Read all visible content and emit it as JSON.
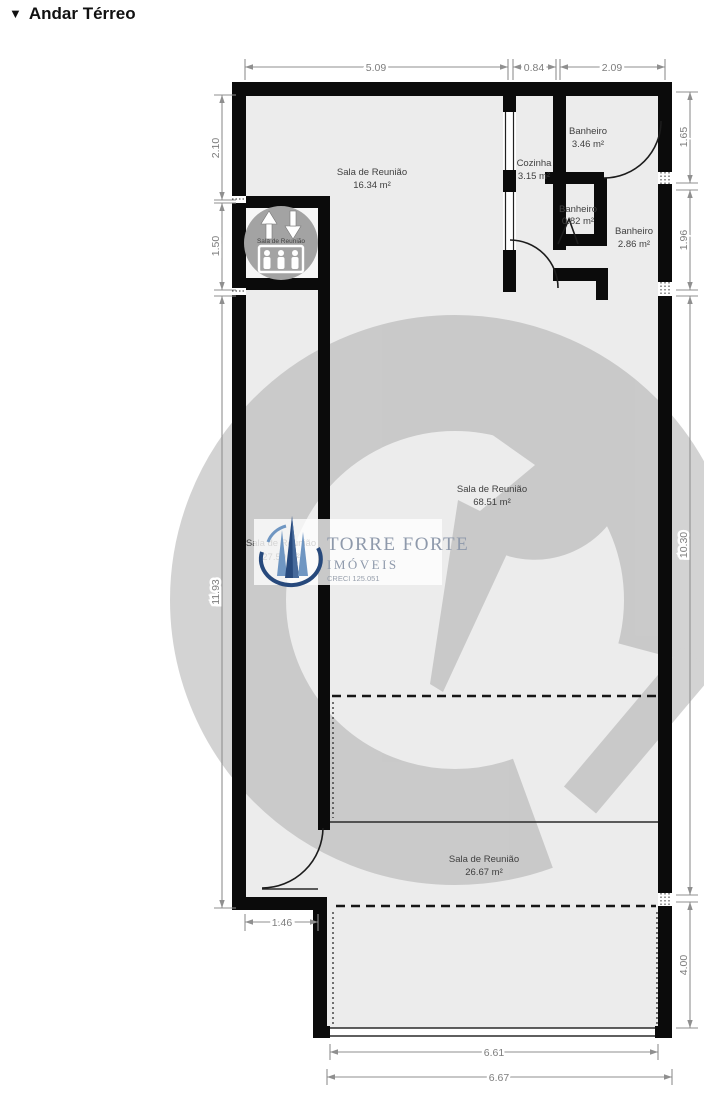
{
  "title": {
    "marker": "▼",
    "text": "Andar Térreo"
  },
  "rooms": [
    {
      "name": "Sala de Reunião",
      "area": "16.34 m²"
    },
    {
      "name": "Cozinha",
      "area": "3.15 m²"
    },
    {
      "name": "Banheiro",
      "area": "3.46 m²"
    },
    {
      "name": "Banheiro",
      "area": "0.82 m²"
    },
    {
      "name": "Banheiro",
      "area": "2.86 m²"
    },
    {
      "name": "Sala de Reunião",
      "area": "68.51 m²"
    },
    {
      "name": "Sala de Reunião",
      "area": "27.59 m²"
    },
    {
      "name": "Sala de Reunião",
      "area": "26.67 m²"
    }
  ],
  "elevator_label": "Sala de Reunião",
  "dimensions": {
    "top": [
      "5.09",
      "0.84",
      "2.09"
    ],
    "left": [
      "2.10",
      "1.50",
      "11.93"
    ],
    "right": [
      "1.65",
      "1.96",
      "10.30",
      "4.00"
    ],
    "bottom": [
      "1.46",
      "6.61",
      "6.67"
    ]
  },
  "watermark": {
    "brand": "TORRE FORTE",
    "sub": "IMÓVEIS",
    "creci": "CRECI 125.051"
  },
  "colors": {
    "wall": "#0b0b0b",
    "floor": "#ececec",
    "dimension": "#8f8f8f",
    "watermark_gray": "#a8a8a8",
    "logo_text": "#8e99ab",
    "tower_dark": "#27497c",
    "tower_light": "#6f96c2"
  }
}
